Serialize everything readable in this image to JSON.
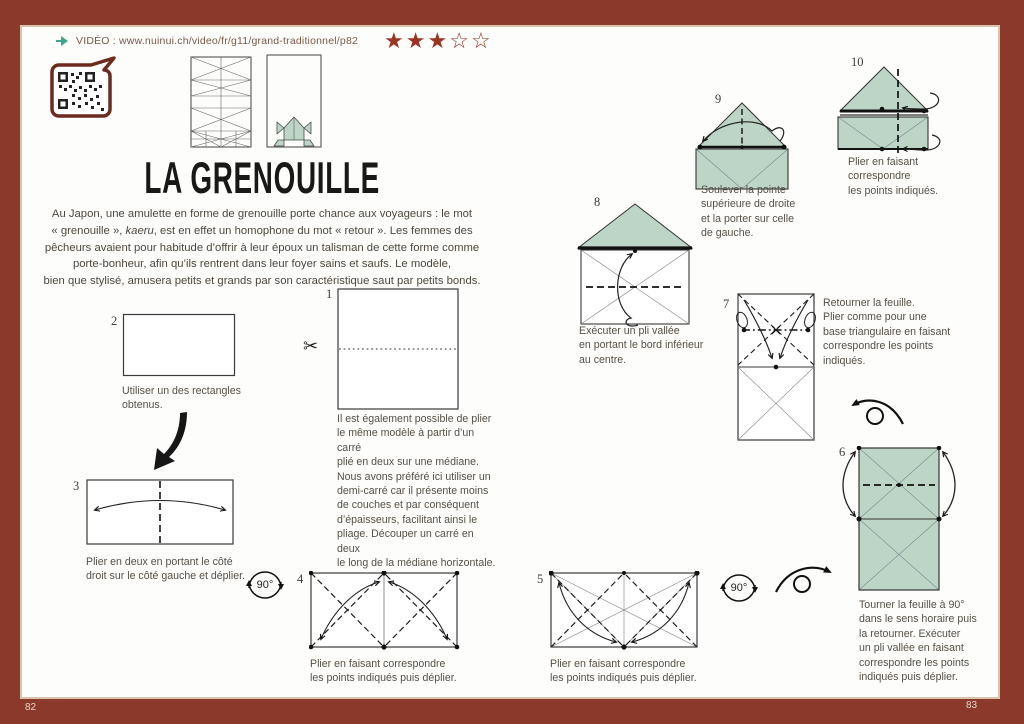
{
  "page": {
    "title": "LA GRENOUILLE",
    "left_number": "82",
    "right_number": "83"
  },
  "header": {
    "video_label": "VIDÉO : www.nuinui.ch/video/fr/g11/grand-traditionnel/p82",
    "stars": [
      "★",
      "★",
      "★",
      "☆",
      "☆"
    ]
  },
  "intro": {
    "pre": "Au Japon, une amulette en forme de grenouille porte chance aux voyageurs : le mot\n« grenouille », ",
    "italic": "kaeru",
    "post": ", est en effet un homophone du mot « retour ». Les femmes des\npêcheurs avaient pour habitude d’offrir à leur époux un talisman de cette forme comme\nporte-bonheur, afin qu’ils rentrent dans leur foyer sains et saufs. Le modèle,\nbien que stylisé, amusera petits et grands par son caractéristique saut par petits bonds."
  },
  "symbols": {
    "rotate_90": "90°"
  },
  "steps": {
    "s1": {
      "num": "1",
      "caption": "Il est également possible de plier\nle même modèle à partir d’un carré\nplié en deux sur une médiane.\nNous avons préféré ici utiliser un\ndemi-carré car il présente moins\nde couches et par conséquent\nd’épaisseurs, facilitant ainsi le\npliage. Découper un carré en deux\nle long de la médiane horizontale."
    },
    "s2": {
      "num": "2",
      "caption": "Utiliser un des rectangles\nobtenus."
    },
    "s3": {
      "num": "3",
      "caption": "Plier en deux en portant le côté\ndroit sur le côté gauche et déplier."
    },
    "s4": {
      "num": "4",
      "caption": "Plier en faisant correspondre\nles points indiqués puis déplier."
    },
    "s5": {
      "num": "5",
      "caption": "Plier en faisant correspondre\nles points indiqués puis déplier."
    },
    "s6": {
      "num": "6",
      "caption": "Tourner la feuille à 90°\ndans le sens horaire puis\nla retourner. Exécuter\nun pli vallée en faisant\ncorrespondre les points\nindiqués puis déplier."
    },
    "s7": {
      "num": "7",
      "caption": "Retourner la feuille.\nPlier comme pour une\nbase triangulaire en faisant\ncorrespondre les points\nindiqués."
    },
    "s8": {
      "num": "8",
      "caption": "Exécuter un pli vallée\nen portant le bord inférieur\nau centre."
    },
    "s9": {
      "num": "9",
      "caption": "Soulever la pointe\nsupérieure de droite\net la porter sur celle\nde gauche."
    },
    "s10": {
      "num": "10",
      "caption": "Plier en faisant\ncorrespondre\nles points indiqués."
    }
  },
  "colors": {
    "border_red": "#8b392b",
    "star_red": "#9c3424",
    "paper_green": "#bcd5c6",
    "accent_teal": "#3fa48c"
  }
}
